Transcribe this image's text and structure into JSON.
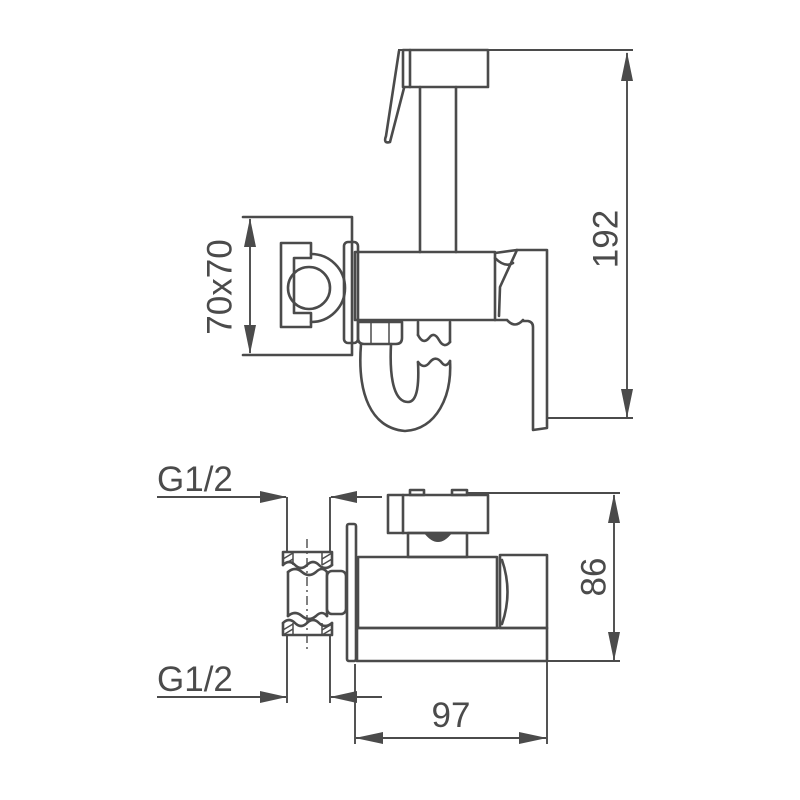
{
  "colors": {
    "background": "#ffffff",
    "line": "#4b4b4b"
  },
  "side_view": {
    "plate_dimension": "70x70",
    "height_dimension": "192"
  },
  "plan_view": {
    "thread_top_label": "G1/2",
    "thread_bottom_label": "G1/2",
    "depth_dimension": "86",
    "width_dimension": "97"
  }
}
